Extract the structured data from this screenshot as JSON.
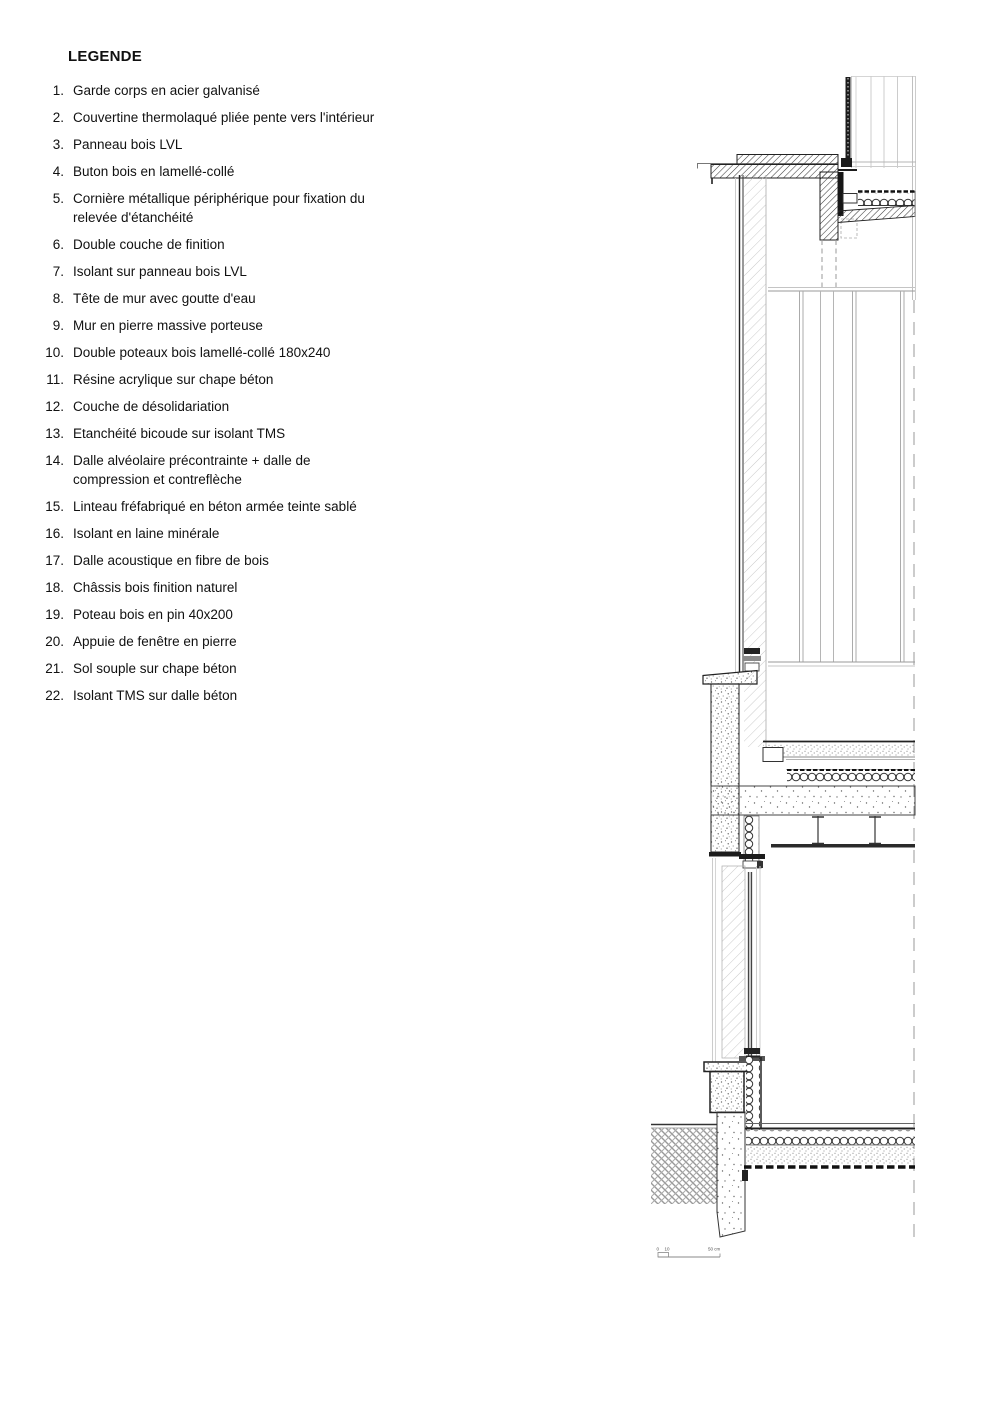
{
  "legend": {
    "title": "LEGENDE",
    "items": [
      {
        "n": "1.",
        "text": "Garde corps en acier galvanisé"
      },
      {
        "n": "2.",
        "text": "Couvertine thermolaqué pliée pente vers l'intérieur"
      },
      {
        "n": "3.",
        "text": "Panneau bois LVL"
      },
      {
        "n": "4.",
        "text": "Buton bois en lamellé-collé"
      },
      {
        "n": "5.",
        "text": "Cornière métallique périphérique pour fixation du relevée d'étanchéité"
      },
      {
        "n": "6.",
        "text": "Double couche de finition"
      },
      {
        "n": "7.",
        "text": "Isolant sur panneau bois LVL"
      },
      {
        "n": "8.",
        "text": "Tête de mur avec goutte d'eau"
      },
      {
        "n": "9.",
        "text": "Mur en pierre massive porteuse"
      },
      {
        "n": "10.",
        "text": "Double poteaux bois lamellé-collé 180x240"
      },
      {
        "n": "11.",
        "text": "Résine acrylique sur chape béton"
      },
      {
        "n": "12.",
        "text": "Couche de désolidariation"
      },
      {
        "n": "13.",
        "text": "Etanchéité bicoude sur isolant TMS"
      },
      {
        "n": "14.",
        "text": "Dalle alvéolaire précontrainte + dalle de compression et contreflèche"
      },
      {
        "n": "15.",
        "text": "Linteau fréfabriqué en béton armée  teinte sablé"
      },
      {
        "n": "16.",
        "text": "Isolant en laine minérale"
      },
      {
        "n": "17.",
        "text": "Dalle acoustique en fibre de bois"
      },
      {
        "n": "18.",
        "text": "Châssis bois finition naturel"
      },
      {
        "n": "19.",
        "text": "Poteau bois en pin 40x200"
      },
      {
        "n": "20.",
        "text": "Appuie de fenêtre en pierre"
      },
      {
        "n": "21.",
        "text": "Sol souple sur chape béton"
      },
      {
        "n": "22.",
        "text": "Isolant TMS sur dalle béton"
      }
    ]
  },
  "scalebar": {
    "zero": "0",
    "ten": "10",
    "end": "50 cm"
  },
  "colors": {
    "ink": "#1c1c1c",
    "line": "#333333",
    "light_line": "#c8c8c8",
    "background": "#ffffff"
  }
}
